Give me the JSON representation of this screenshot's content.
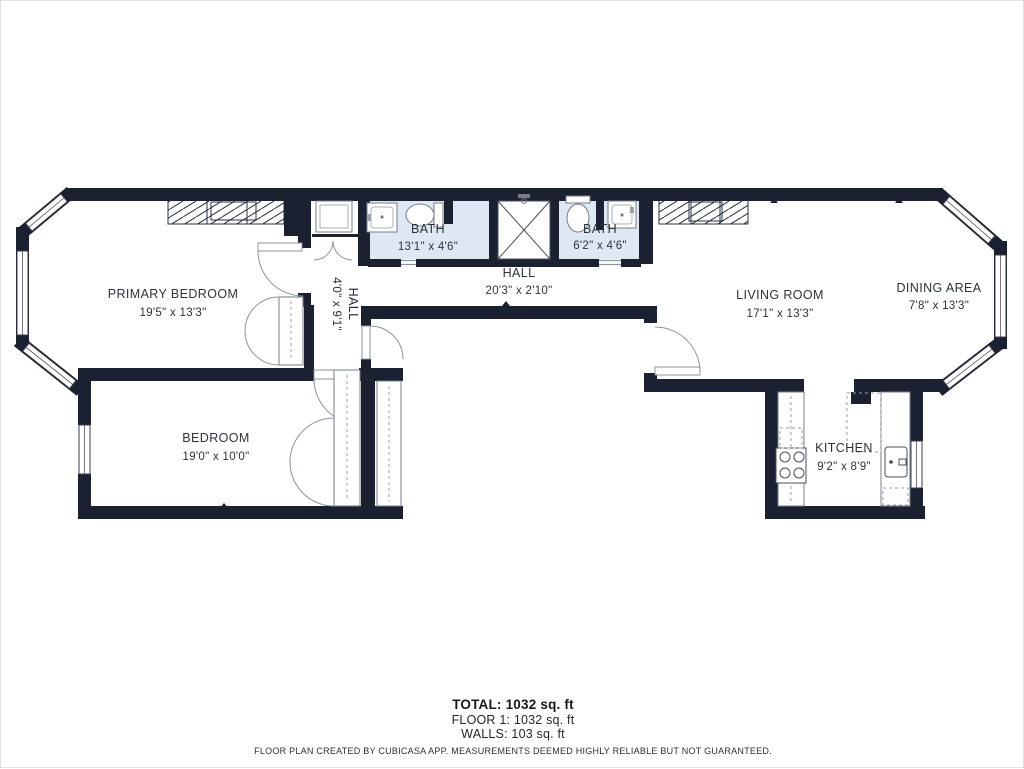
{
  "rooms": {
    "primary_bedroom": {
      "name": "PRIMARY BEDROOM",
      "dims": "19'5\" x 13'3\""
    },
    "bedroom": {
      "name": "BEDROOM",
      "dims": "19'0\" x 10'0\""
    },
    "hall_v": {
      "name": "HALL",
      "dims": "4'0\" x 9'1\""
    },
    "bath_left": {
      "name": "BATH",
      "dims": "13'1\" x 4'6\""
    },
    "hall_h": {
      "name": "HALL",
      "dims": "20'3\" x 2'10\""
    },
    "bath_right": {
      "name": "BATH",
      "dims": "6'2\" x 4'6\""
    },
    "living_room": {
      "name": "LIVING ROOM",
      "dims": "17'1\" x 13'3\""
    },
    "dining_area": {
      "name": "DINING AREA",
      "dims": "7'8\" x 13'3\""
    },
    "kitchen": {
      "name": "KITCHEN",
      "dims": "9'2\" x 8'9\""
    }
  },
  "summary": {
    "total": "TOTAL: 1032 sq. ft",
    "floor": "FLOOR 1: 1032 sq. ft",
    "walls": "WALLS: 103 sq. ft"
  },
  "disclaimer": "FLOOR PLAN CREATED BY CUBICASA APP. MEASUREMENTS DEEMED HIGHLY RELIABLE BUT NOT GUARANTEED.",
  "colors": {
    "wall": "#1b2130",
    "bath_floor": "#dde8f2",
    "fixture_line": "#777d86",
    "text": "#2e3339"
  }
}
